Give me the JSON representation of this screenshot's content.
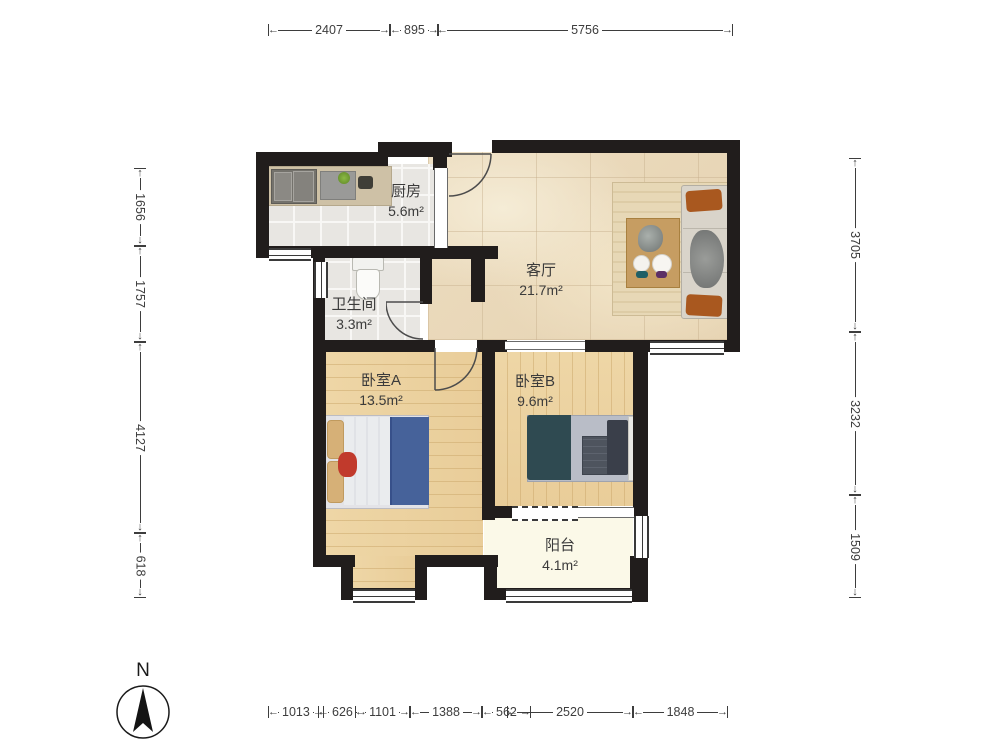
{
  "compass": {
    "label": "N"
  },
  "rooms": {
    "kitchen": {
      "name": "厨房",
      "area": "5.6m²"
    },
    "living_room": {
      "name": "客厅",
      "area": "21.7m²"
    },
    "bathroom": {
      "name": "卫生间",
      "area": "3.3m²"
    },
    "bedroom_a": {
      "name": "卧室A",
      "area": "13.5m²"
    },
    "bedroom_b": {
      "name": "卧室B",
      "area": "9.6m²"
    },
    "balcony": {
      "name": "阳台",
      "area": "4.1m²"
    }
  },
  "dimensions_mm": {
    "top": [
      "2407",
      "895",
      "5756"
    ],
    "bottom": [
      "1013",
      "626",
      "1101",
      "1388",
      "562",
      "2520",
      "1848"
    ],
    "left": [
      "1656",
      "1757",
      "4127",
      "618"
    ],
    "right": [
      "3705",
      "3232",
      "1509"
    ]
  },
  "colors": {
    "wall": "#211d1c",
    "marble_floor": "#e9d8ba",
    "wood_floor": "#ecd2a2",
    "tile_floor": "#e8e6e2",
    "balcony_floor": "#fbf9e8",
    "sofa_pillow": "#a9581f",
    "bed_a_blanket": "#46629a",
    "bed_b_blanket": "#2f4a51"
  }
}
